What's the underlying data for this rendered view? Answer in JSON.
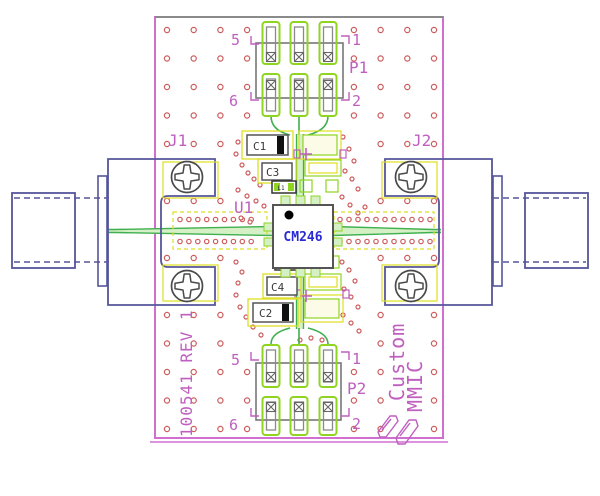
{
  "board": {
    "part_number": "100541 REV 1",
    "brand_top": "Custom",
    "brand_bottom": "MMIC"
  },
  "chip": {
    "refdes": "U1",
    "part": "CM246"
  },
  "connectors": {
    "j1": "J1",
    "j2": "J2"
  },
  "headers": {
    "p1": {
      "label": "P1",
      "pin_tl": "5",
      "pin_tr": "1",
      "pin_bl": "6",
      "pin_br": "2"
    },
    "p2": {
      "label": "P2",
      "pin_tl": "5",
      "pin_tr": "1",
      "pin_bl": "6",
      "pin_br": "2"
    }
  },
  "components": {
    "c1": "C1",
    "c2": "C2",
    "c3": "C3",
    "c4": "C4",
    "l1": "L1",
    "l2": "L2"
  },
  "colors": {
    "board_outline_pink": "#d06fd0",
    "silkscreen_magenta": "#bf5fbf",
    "via_red": "#cd5c5c",
    "pad_green": "#8fd420",
    "trace_green": "#3faf4f",
    "trace_fill": "#d4f0c4",
    "keepout_yellow": "#dede22",
    "connector_navy": "#55559b",
    "outline_gray": "#8a8a8a",
    "chip_text_blue": "#2a2ad4"
  }
}
